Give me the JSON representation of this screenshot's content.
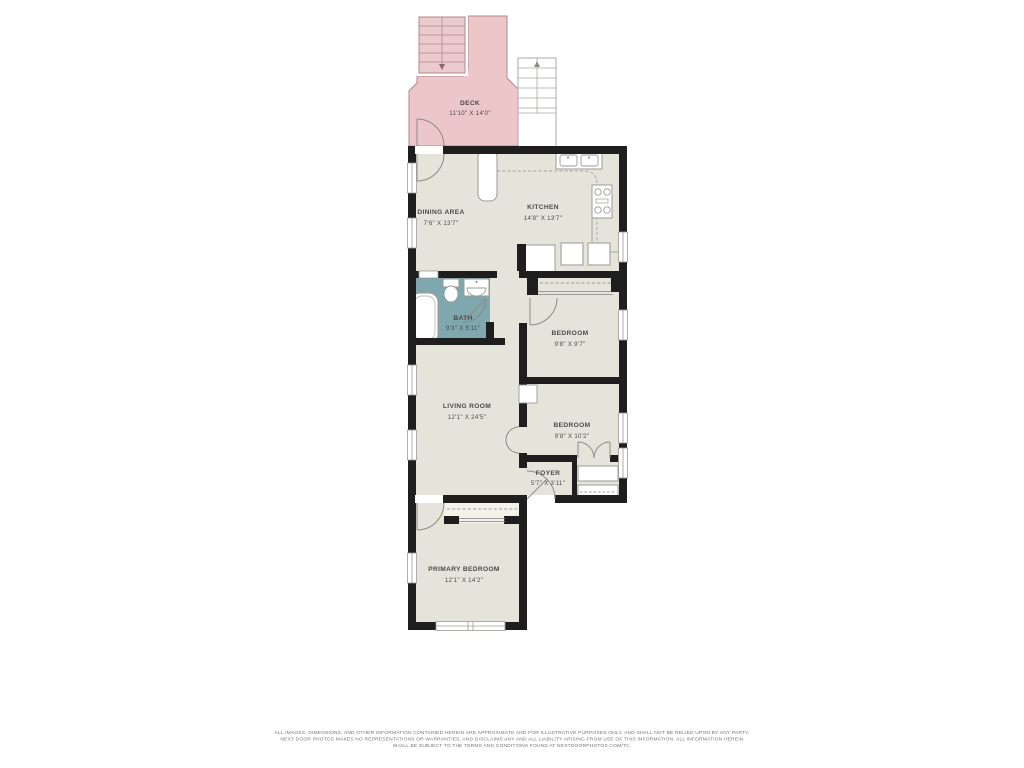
{
  "plan": {
    "colors": {
      "floor": "#e5e4da",
      "deck": "#edc6c9",
      "deck_line": "#b2898c",
      "bath": "#7fa7ae",
      "wall": "#1e1e1e",
      "fixture_line": "#9a9a96",
      "label_text": "#4a4a46",
      "disclaimer_text": "#757575"
    },
    "rooms": [
      {
        "id": "deck",
        "name": "DECK",
        "dims": "11'10\" X 14'0\""
      },
      {
        "id": "dining",
        "name": "DINING AREA",
        "dims": "7'6\" X 13'7\""
      },
      {
        "id": "kitchen",
        "name": "KITCHEN",
        "dims": "14'8\" X 13'7\""
      },
      {
        "id": "bath",
        "name": "BATH",
        "dims": "9'3\" X 5'11\""
      },
      {
        "id": "bedroom1",
        "name": "BEDROOM",
        "dims": "9'8\" X 9'7\""
      },
      {
        "id": "bedroom2",
        "name": "BEDROOM",
        "dims": "9'8\" X 10'2\""
      },
      {
        "id": "living",
        "name": "LIVING ROOM",
        "dims": "12'1\" X 24'5\""
      },
      {
        "id": "foyer",
        "name": "FOYER",
        "dims": "5'7\" X 3'11\""
      },
      {
        "id": "primary",
        "name": "PRIMARY BEDROOM",
        "dims": "12'1\" X 14'2\""
      }
    ],
    "disclaimer": {
      "line1": "ALL IMAGES, DIMENSIONS, AND OTHER INFORMATION CONTAINED HEREIN ARE APPROXIMATE AND FOR ILLUSTRATIVE PURPOSES ONLY, AND SHALL NOT BE RELIED UPON BY ANY PARTY.",
      "line2": "NEXT DOOR PHOTOS MAKES NO REPRESENTATIONS OR WARRANTIES, AND DISCLAIMS ANY AND ALL LIABILITY ARISING FROM USE OF THIS INFORMATION. ALL INFORMATION HEREIN",
      "line3": "SHALL BE SUBJECT TO THE TERMS AND CONDITIONS FOUND AT NEXTDOORPHOTOS.COM/TC."
    }
  }
}
